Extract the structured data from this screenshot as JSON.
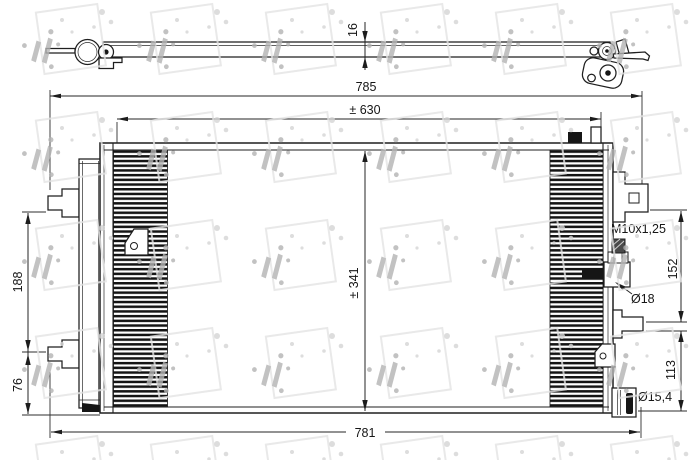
{
  "brand": "NRF",
  "drawing": {
    "labels": {
      "side_thickness": "16",
      "overall_width_top": "785",
      "connection_span": "± 630",
      "core_height": "± 341",
      "left_bracket_span": "188",
      "left_bracket_to_bottom": "76",
      "right_upper_span": "152",
      "right_lower_span": "113",
      "overall_width_bottom": "781",
      "thread": "M10x1,25",
      "valve_diameter": "Ø18",
      "pipe_diameter": "Ø15,4"
    }
  }
}
